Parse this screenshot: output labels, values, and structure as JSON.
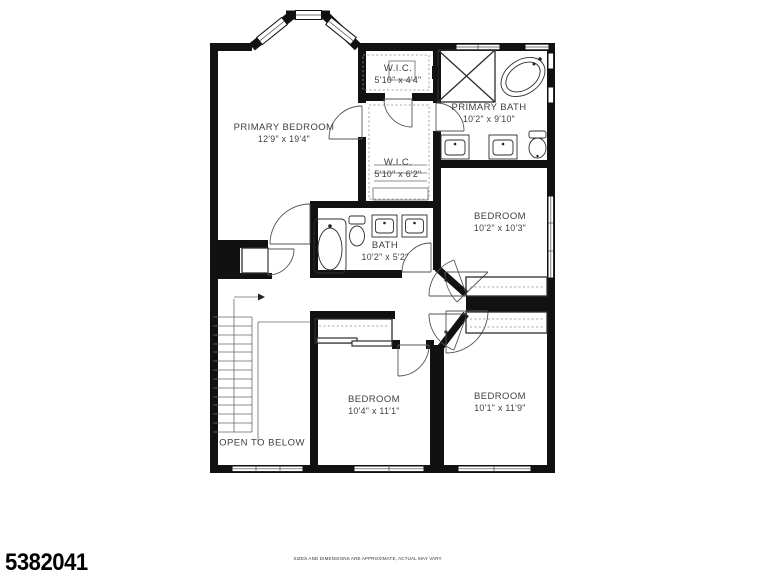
{
  "plan": {
    "rooms": [
      {
        "name": "PRIMARY BEDROOM",
        "dims": "12'9\" x 19'4\""
      },
      {
        "name": "W.I.C.",
        "dims": "5'10\" x 4'4\""
      },
      {
        "name": "PRIMARY BATH",
        "dims": "10'2\" x 9'10\""
      },
      {
        "name": "W.I.C.",
        "dims": "5'10\" x 6'2\""
      },
      {
        "name": "BATH",
        "dims": "10'2\" x 5'2\""
      },
      {
        "name": "BEDROOM",
        "dims": "10'2\" x 10'3\""
      },
      {
        "name": "BEDROOM",
        "dims": "10'4\" x 11'1\""
      },
      {
        "name": "BEDROOM",
        "dims": "10'1\" x 11'9\""
      }
    ],
    "annotations": {
      "open_to_below": "OPEN TO BELOW"
    }
  },
  "footer": {
    "listing_id": "5382041",
    "disclaimer": "SIZES AND DIMENSIONS ARE APPROXIMATE, ACTUAL MAY VARY."
  },
  "colors": {
    "wall": "#111111",
    "line": "#6a6a6a",
    "label": "#3f3f3f",
    "bg": "#ffffff"
  }
}
